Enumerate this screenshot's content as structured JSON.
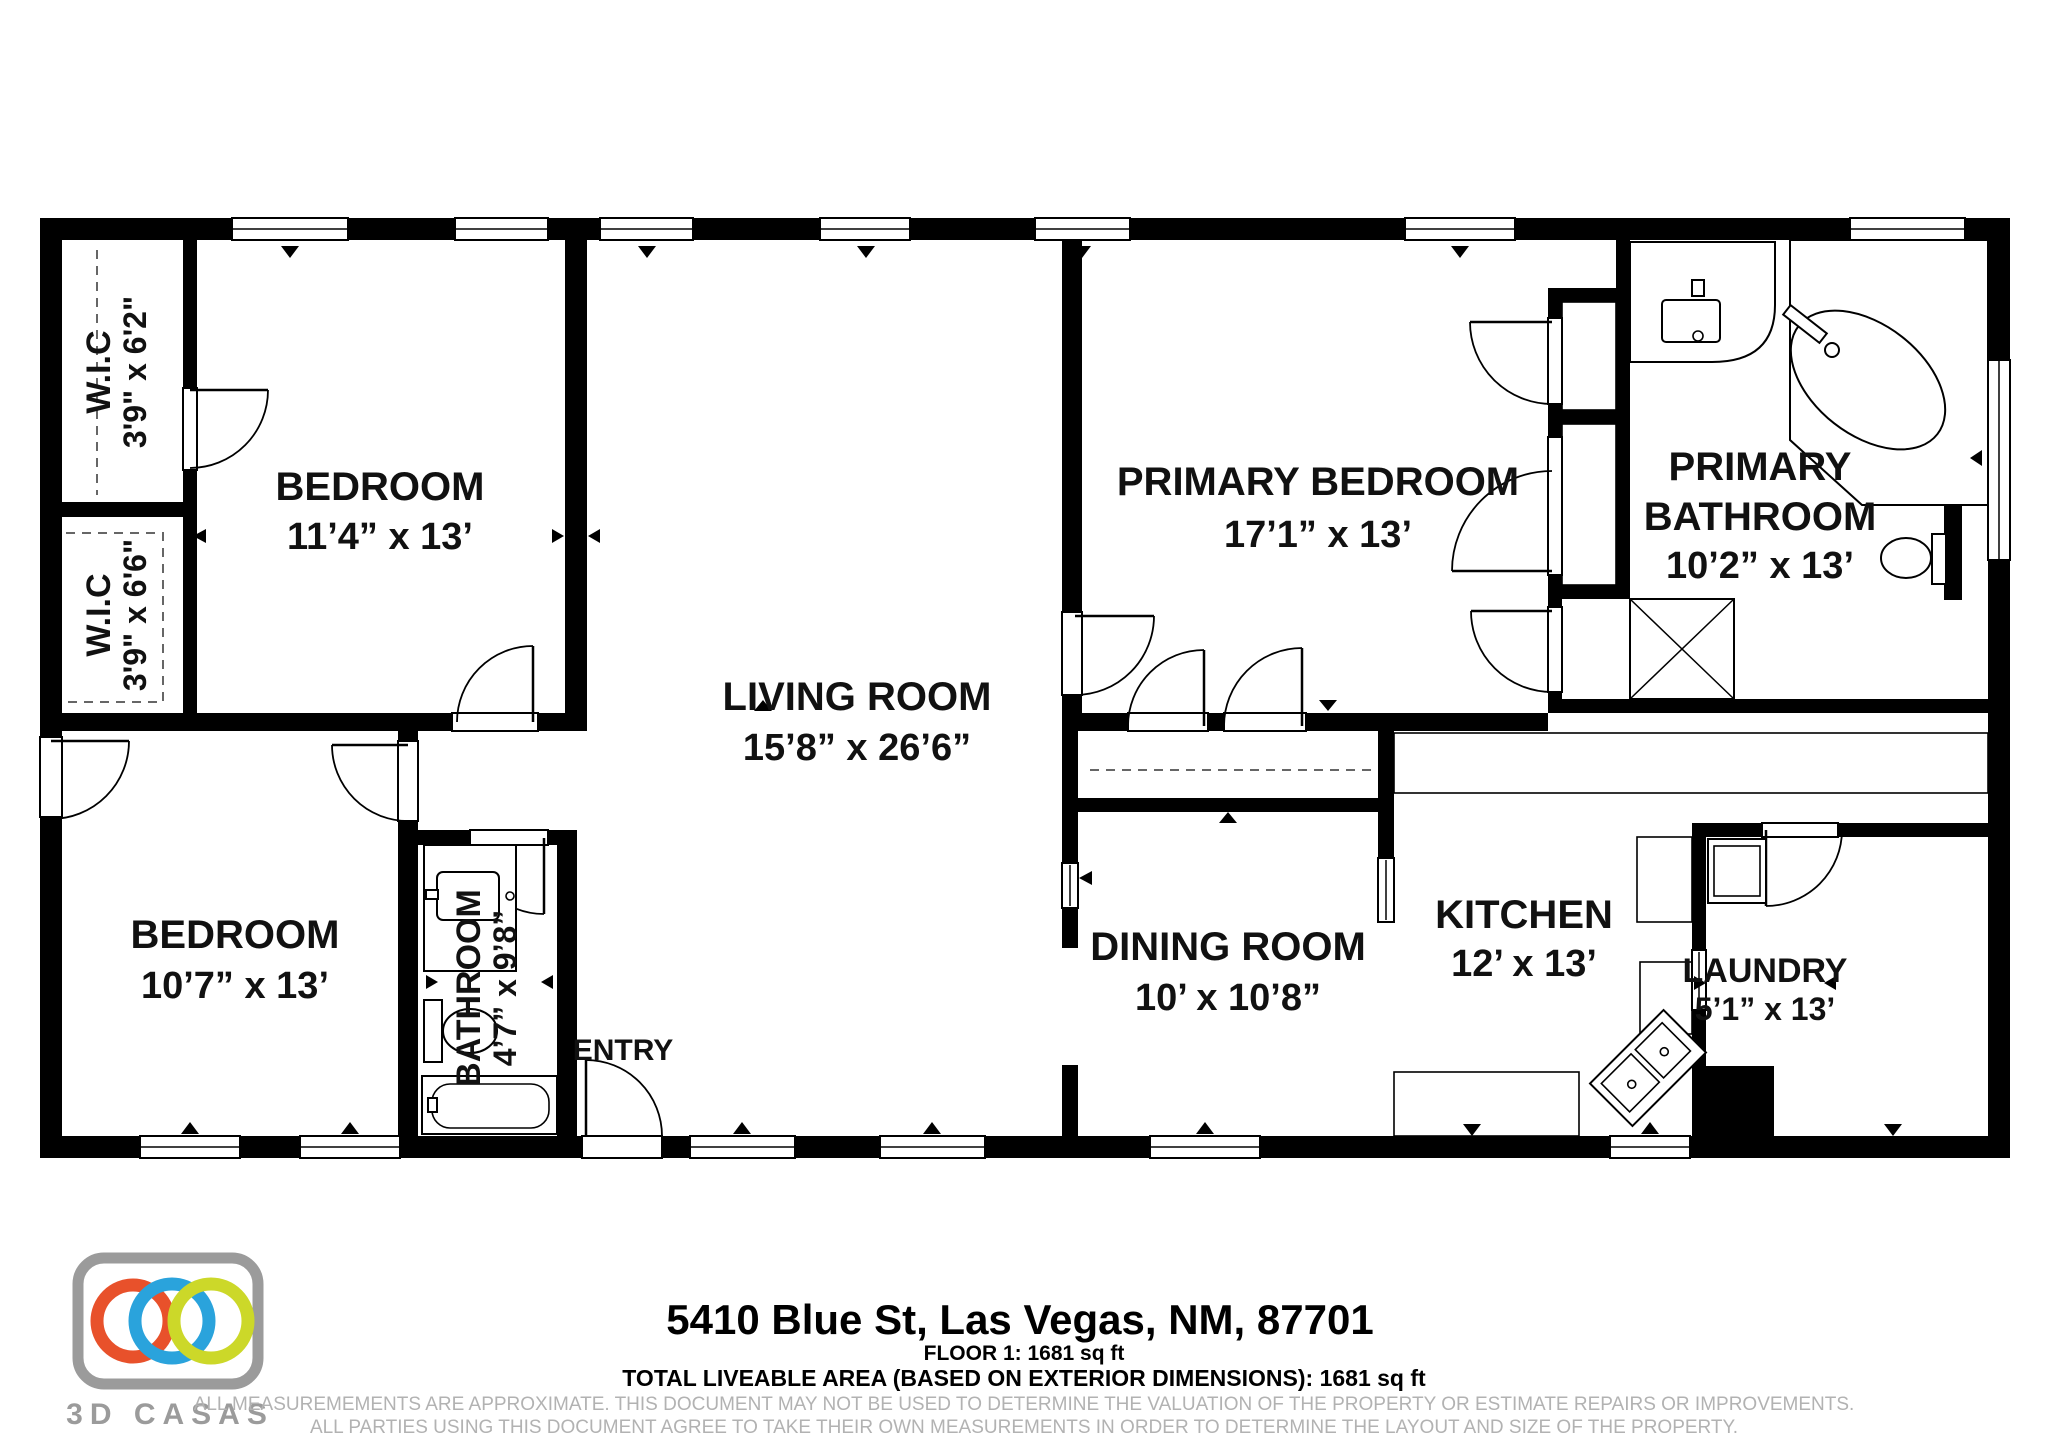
{
  "rooms": {
    "wic_top": {
      "name": "W.I.C",
      "dims": "3'9\" x 6'2\""
    },
    "wic_mid": {
      "name": "W.I.C",
      "dims": "3'9\" x 6'6\""
    },
    "bedroom_top": {
      "name": "BEDROOM",
      "dims": "11’4” x 13’"
    },
    "bedroom_bottom": {
      "name": "BEDROOM",
      "dims": "10’7” x 13’"
    },
    "bathroom": {
      "name": "BATHROOM",
      "dims": "4’7” x 9’8”"
    },
    "entry": {
      "name": "ENTRY"
    },
    "living": {
      "name": "LIVING ROOM",
      "dims": "15’8” x 26’6”"
    },
    "primary_bedroom": {
      "name": "PRIMARY BEDROOM",
      "dims": "17’1” x 13’"
    },
    "primary_bathroom": {
      "line1": "PRIMARY",
      "line2": "BATHROOM",
      "dims": "10’2” x 13’"
    },
    "dining": {
      "name": "DINING ROOM",
      "dims": "10’ x 10’8”"
    },
    "kitchen": {
      "name": "KITCHEN",
      "dims": "12’ x 13’"
    },
    "laundry": {
      "name": "LAUNDRY",
      "dims": "5’1” x 13’"
    }
  },
  "footer": {
    "address": "5410 Blue St, Las Vegas, NM, 87701",
    "floor_line": "FLOOR 1: 1681 sq ft",
    "total_line": "TOTAL LIVEABLE AREA (BASED ON EXTERIOR DIMENSIONS): 1681 sq ft",
    "disclaimer_line1": "ALL MEASUREMEMENTS ARE APPROXIMATE. THIS DOCUMENT MAY NOT BE USED TO DETERMINE THE VALUATION OF THE PROPERTY OR ESTIMATE REPAIRS OR IMPROVEMENTS.",
    "disclaimer_line2": "ALL PARTIES USING THIS DOCUMENT AGREE TO TAKE THEIR OWN MEASUREMENTS IN ORDER TO DETERMINE THE LAYOUT AND SIZE OF THE PROPERTY."
  },
  "logo": {
    "brand": "3D CASAS"
  },
  "colors": {
    "wall": "#000000",
    "logo_gray": "#9b9b9b",
    "ring_orange": "#e8512b",
    "ring_blue": "#2aa3dc",
    "ring_yellow": "#ccd829",
    "disclaimer_gray": "#b2b2b2"
  }
}
